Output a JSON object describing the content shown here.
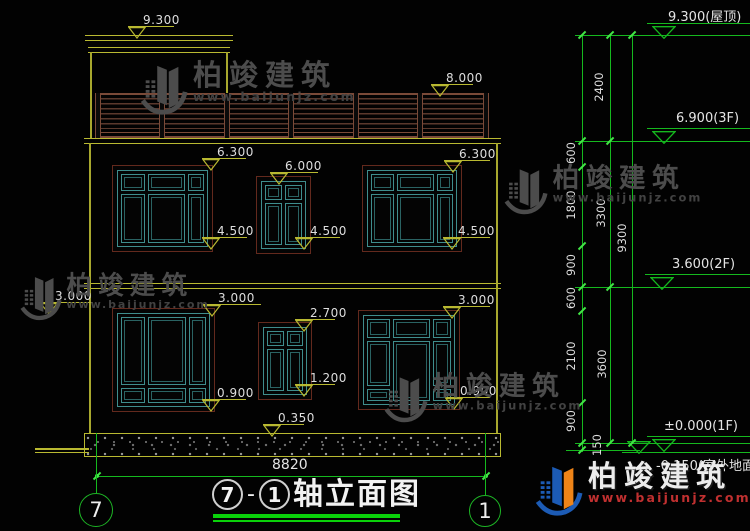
{
  "drawing": {
    "title": {
      "prefix_axis": "7",
      "dash": "-",
      "suffix_axis": "1",
      "name": "轴立面图"
    },
    "axis_bubbles": [
      {
        "label": "7"
      },
      {
        "label": "1"
      }
    ],
    "width_dim": {
      "label": "8820",
      "y": 476,
      "x1": 97,
      "x2": 487,
      "label_x": 272,
      "label_y": 458
    },
    "elevation_markers": [
      {
        "label": "9.300",
        "x": 128,
        "y": 26,
        "w": 46
      },
      {
        "label": "8.000",
        "x": 431,
        "y": 84,
        "w": 42
      },
      {
        "label": "6.300",
        "x": 202,
        "y": 158,
        "w": 44
      },
      {
        "label": "6.000",
        "x": 270,
        "y": 172,
        "w": 48
      },
      {
        "label": "6.300",
        "x": 444,
        "y": 160,
        "w": 46
      },
      {
        "label": "4.500",
        "x": 202,
        "y": 237,
        "w": 45
      },
      {
        "label": "4.500",
        "x": 295,
        "y": 237,
        "w": 45
      },
      {
        "label": "4.500",
        "x": 443,
        "y": 237,
        "w": 47
      },
      {
        "label": "3.000",
        "x": 40,
        "y": 302,
        "w": 53
      },
      {
        "label": "3.000",
        "x": 203,
        "y": 304,
        "w": 58
      },
      {
        "label": "2.700",
        "x": 295,
        "y": 319,
        "w": 40
      },
      {
        "label": "3.000",
        "x": 443,
        "y": 306,
        "w": 47
      },
      {
        "label": "0.900",
        "x": 202,
        "y": 399,
        "w": 44
      },
      {
        "label": "1.200",
        "x": 295,
        "y": 384,
        "w": 40
      },
      {
        "label": "0.900",
        "x": 445,
        "y": 397,
        "w": 45
      },
      {
        "label": "0.350",
        "x": 263,
        "y": 424,
        "w": 41
      }
    ],
    "level_markers": [
      {
        "label": "9.300(屋顶)",
        "line_y": 23,
        "tri_x": 652,
        "text_x": 668,
        "below": false
      },
      {
        "label": "6.900(3F)",
        "line_y": 128,
        "tri_x": 652,
        "text_x": 676,
        "below": false
      },
      {
        "label": "3.600(2F)",
        "line_y": 274,
        "tri_x": 650,
        "text_x": 672,
        "below": false
      },
      {
        "label": "±0.000(1F)",
        "line_y": 436,
        "tri_x": 652,
        "text_x": 664,
        "below": false
      },
      {
        "label": "-0.150(室外地面)",
        "line_y": 452,
        "tri_x": 627,
        "text_x": 656,
        "below": true
      }
    ],
    "hlines": [
      {
        "y": 35,
        "x1": 575,
        "x2": 750
      },
      {
        "y": 141,
        "x1": 575,
        "x2": 750
      },
      {
        "y": 287,
        "x1": 575,
        "x2": 750
      },
      {
        "y": 443,
        "x1": 575,
        "x2": 750
      },
      {
        "y": 450,
        "x1": 566,
        "x2": 640
      }
    ],
    "chains": [
      {
        "x": 582,
        "y1": 35,
        "y2": 452,
        "ticks": [
          35,
          141,
          167,
          246,
          287,
          311,
          403,
          443,
          450
        ],
        "labels": [
          {
            "text": "600",
            "cx": 571,
            "cy": 154
          },
          {
            "text": "1800",
            "cx": 571,
            "cy": 206
          },
          {
            "text": "900",
            "cx": 571,
            "cy": 266
          },
          {
            "text": "600",
            "cx": 571,
            "cy": 299
          },
          {
            "text": "2100",
            "cx": 571,
            "cy": 357
          },
          {
            "text": "900",
            "cx": 571,
            "cy": 422
          },
          {
            "text": "150",
            "cx": 597,
            "cy": 446
          }
        ]
      },
      {
        "x": 610,
        "y1": 35,
        "y2": 443,
        "ticks": [
          35,
          141,
          287,
          443
        ],
        "labels": [
          {
            "text": "2400",
            "cx": 599,
            "cy": 88
          },
          {
            "text": "3300",
            "cx": 601,
            "cy": 214
          },
          {
            "text": "3600",
            "cx": 602,
            "cy": 365
          }
        ]
      },
      {
        "x": 632,
        "y1": 35,
        "y2": 443,
        "ticks": [
          35,
          443
        ],
        "labels": [
          {
            "text": "9300",
            "cx": 622,
            "cy": 239
          }
        ]
      }
    ],
    "watermarks": [
      {
        "text": "柏竣建筑",
        "url": "www.baijunjz.com",
        "x": 138,
        "y": 60,
        "scale": 1.0
      },
      {
        "text": "柏竣建筑",
        "url": "www.baijunjz.com",
        "x": 18,
        "y": 272,
        "scale": 0.88
      },
      {
        "text": "柏竣建筑",
        "url": "www.baijunjz.com",
        "x": 382,
        "y": 372,
        "scale": 0.92
      },
      {
        "text": "柏竣建筑",
        "url": "www.baijunjz.com",
        "x": 502,
        "y": 164,
        "scale": 0.92
      }
    ],
    "brand_logo": {
      "text": "柏竣建筑",
      "url": "www.baijunjz.com",
      "x": 533,
      "y": 461
    },
    "colors": {
      "cad_yellow": "#b9b931",
      "dim_green": "#15b81e",
      "tick_green": "#42e646",
      "window_teal": "#3f8d8d",
      "frame_brown": "#63291d",
      "rail_brown": "#5a382c",
      "text_white": "#e4e4e4",
      "watermark_gray": "#4c4c4c",
      "logo_blue": "#1c5bb5",
      "logo_orange": "#ef8418",
      "logo_red": "#c03030"
    }
  }
}
